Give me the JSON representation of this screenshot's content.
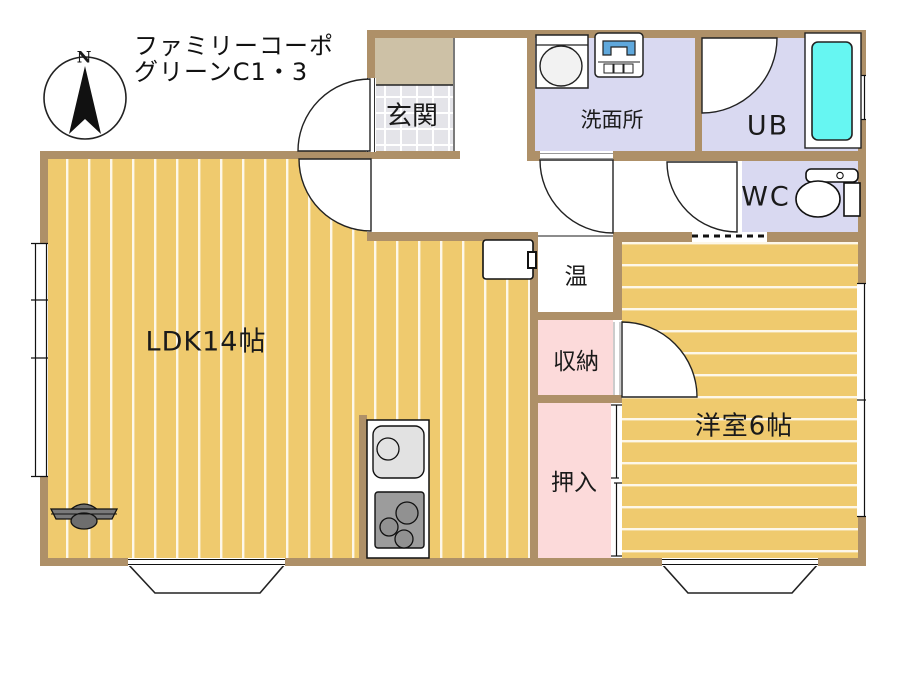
{
  "title": {
    "line1": "ファミリーコーポ",
    "line2": "グリーンC1・3"
  },
  "compass": {
    "label": "N"
  },
  "rooms": {
    "genkan": {
      "label": "玄関"
    },
    "senmenjo": {
      "label": "洗面所"
    },
    "ub": {
      "label": "UB"
    },
    "wc": {
      "label": "WC"
    },
    "onsui": {
      "label": "温"
    },
    "shuno": {
      "label": "収納"
    },
    "oshiire": {
      "label": "押入"
    },
    "ldk": {
      "label": "LDK14帖"
    },
    "yoshitsu": {
      "label": "洋室6帖"
    }
  },
  "colors": {
    "wall": "#AE9068",
    "wood_floor": "#EFCA6E",
    "lavender": "#D9D9F1",
    "pink": "#FCDADA",
    "tile": "#E4E4E9",
    "porch": "#CDC1A6",
    "bathtub": "#66F6F2",
    "washer_blue": "#5FA8DC"
  }
}
